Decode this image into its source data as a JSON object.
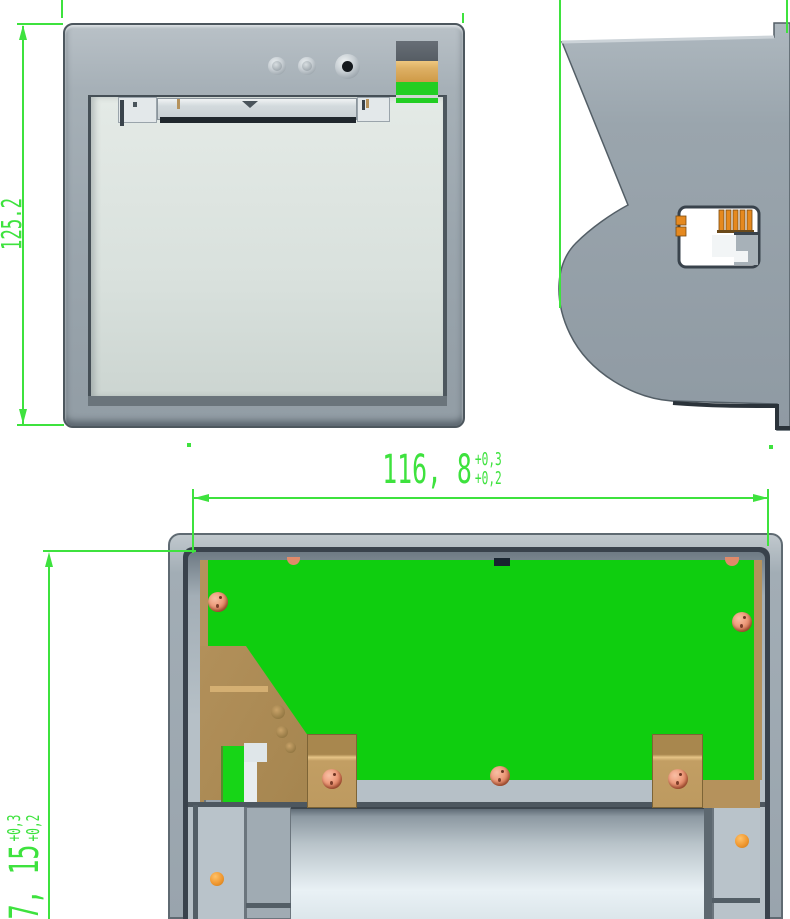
{
  "drawing_title": "",
  "dimensions": {
    "front_height": {
      "value": "125.2"
    },
    "cutout_width": {
      "value": "116, 8",
      "tol_upper": "+0,3",
      "tol_lower": "+0,2"
    },
    "cutout_height": {
      "value": "7, 15",
      "tol_upper": "+0,3",
      "tol_lower": "+0,2"
    }
  },
  "colors": {
    "dimension_green": "#3ee23e",
    "pcb_green": "#0fce0f",
    "case_gray": "#99a4ad",
    "door_gray": "#dce3df",
    "copper_tan": "#b5925c",
    "screw_copper": "#e08a6a",
    "connector_orange": "#e5891f",
    "slot_black": "#20272d",
    "recess_dark": "#39424c"
  }
}
